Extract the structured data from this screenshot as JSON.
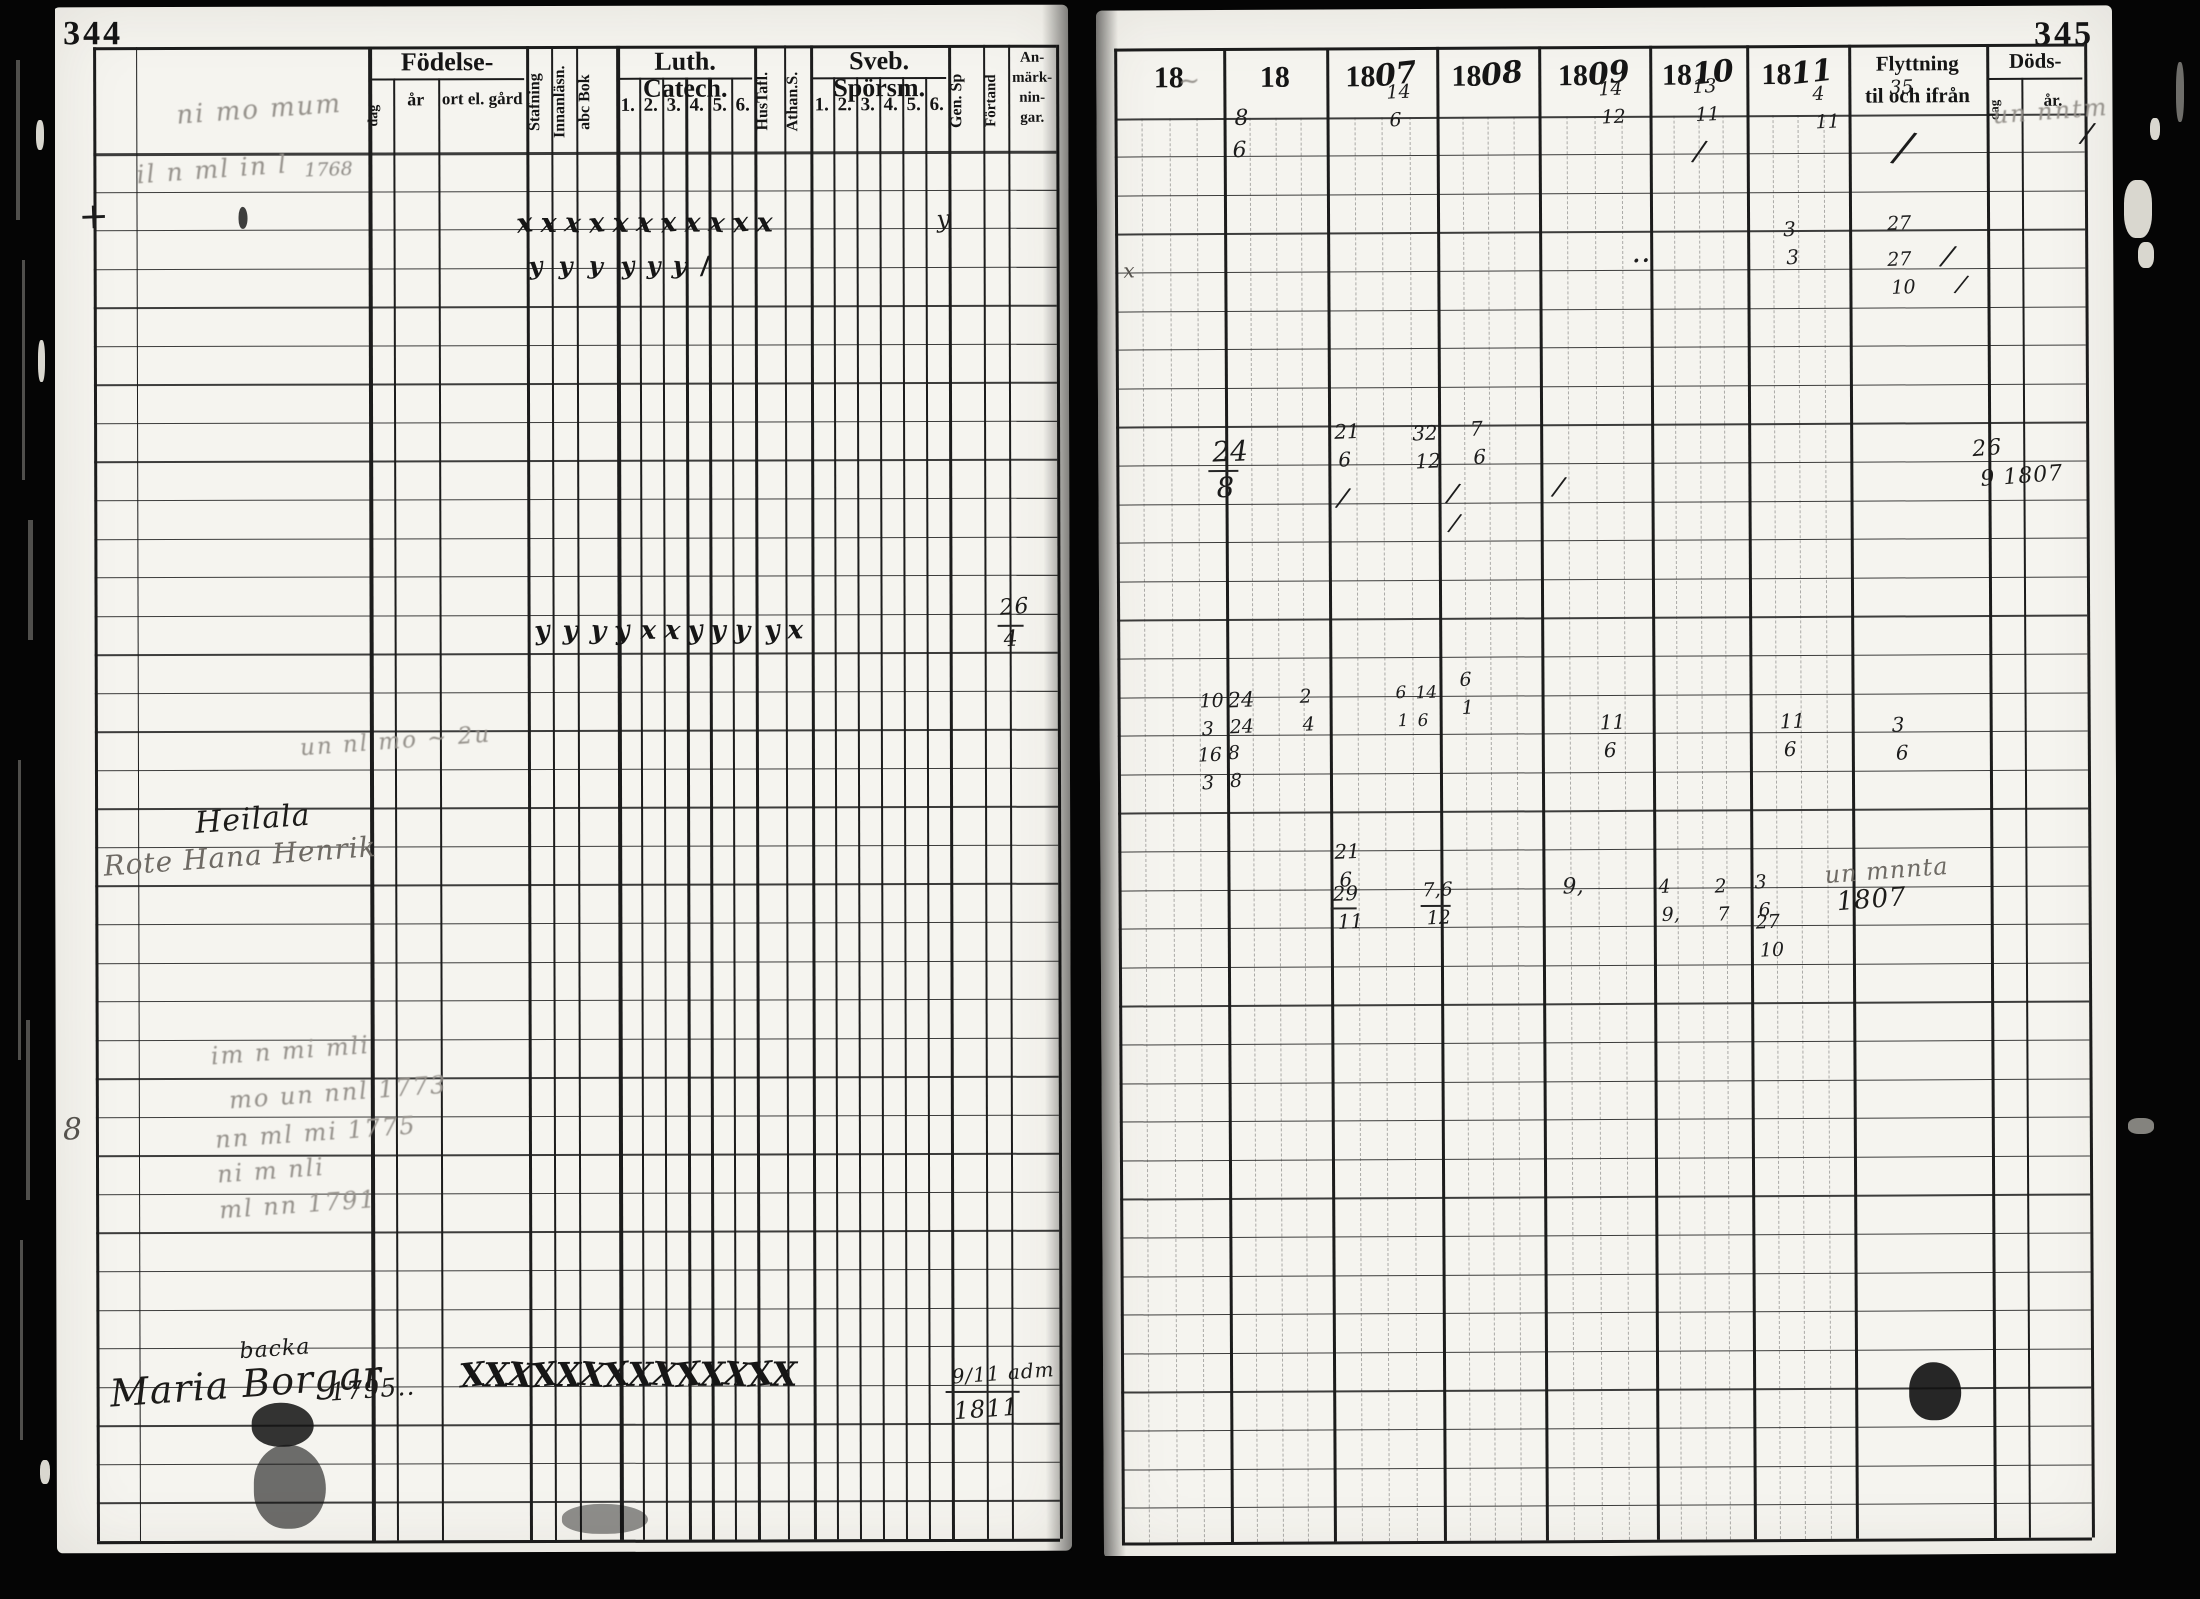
{
  "scan": {
    "left_page_number": "344",
    "right_page_number": "345"
  },
  "left_page": {
    "header": {
      "fodelse_group": "Födelse-",
      "fodelse_sub": [
        "dag",
        "år",
        "ort el. gård"
      ],
      "reading_cols": [
        "Stafning",
        "Innanläsn.",
        "abc Bok"
      ],
      "luth_group": "Luth. Catech.",
      "luth_sub": [
        "1.",
        "2.",
        "3.",
        "4.",
        "5.",
        "6."
      ],
      "mid_cols": [
        "HusTafl.",
        "Athan.S."
      ],
      "sveb_group": "Sveb. Spörsm.",
      "sveb_sub": [
        "1.",
        "2.",
        "3.",
        "4.",
        "5.",
        "6."
      ],
      "tail_cols": [
        "Gen. Sp",
        "Förtand"
      ],
      "anmarkningar_lines": [
        "An-",
        "märk-",
        "nin-",
        "gar."
      ]
    },
    "mark_rows": [
      {
        "y": 210,
        "x0": 518,
        "dx": 24,
        "n": 11,
        "g": "x",
        "f": 27
      },
      {
        "y": 254,
        "xs": [
          530,
          560,
          590,
          622,
          648,
          674,
          702
        ],
        "gs": [
          "y",
          "y",
          "y",
          "y",
          "y",
          "y",
          "/"
        ],
        "f": 24
      },
      {
        "y": 618,
        "xs": [
          535,
          563,
          591,
          615,
          641,
          665,
          688,
          711,
          735,
          765,
          788
        ],
        "gs": [
          "y",
          "y",
          "y",
          "y",
          "x",
          "x",
          "y",
          "y",
          "y",
          "y",
          "x"
        ],
        "f": 26
      },
      {
        "y": 1358,
        "x0": 458,
        "dx": 24,
        "n": 14,
        "g": "X",
        "f": 33
      }
    ],
    "ink": [
      {
        "x": 178,
        "y": 96,
        "t": "ni mo mum",
        "s": "fc",
        "f": 26
      },
      {
        "x": 138,
        "y": 156,
        "t": "il n ml in l",
        "s": "fc",
        "f": 25
      },
      {
        "x": 306,
        "y": 160,
        "t": "1768",
        "s": "f",
        "f": 19
      },
      {
        "x": 80,
        "y": 198,
        "t": "+",
        "f": 36
      },
      {
        "x": 938,
        "y": 208,
        "t": "y",
        "s": "c",
        "f": 24
      },
      {
        "x": 240,
        "y": 206,
        "w": 9,
        "h": 22,
        "s": "blot",
        "o": 0.8
      },
      {
        "x": 300,
        "y": 730,
        "t": "un nl mo ~ 2u",
        "s": "fc",
        "f": 23
      },
      {
        "x": 1000,
        "y": 598,
        "t": "26",
        "s": "c",
        "f": 22
      },
      {
        "x": 998,
        "y": 626,
        "w": 26,
        "s": "hl"
      },
      {
        "x": 1004,
        "y": 630,
        "t": "4",
        "s": "c",
        "f": 22
      },
      {
        "x": 195,
        "y": 804,
        "t": "Heilala",
        "s": "c",
        "f": 30
      },
      {
        "x": 103,
        "y": 842,
        "t": "Rote Hana Henrik",
        "s": "c2",
        "f": 28
      },
      {
        "x": 210,
        "y": 1038,
        "t": "im n mi mli",
        "s": "fc",
        "f": 24
      },
      {
        "x": 228,
        "y": 1080,
        "t": "mo un nnl 1773",
        "s": "fc",
        "f": 24
      },
      {
        "x": 214,
        "y": 1120,
        "t": "nn ml mi 1775",
        "s": "fc",
        "f": 24
      },
      {
        "x": 216,
        "y": 1158,
        "t": "ni m nli",
        "s": "fc",
        "f": 24
      },
      {
        "x": 218,
        "y": 1192,
        "t": "ml nn 1791",
        "s": "fc",
        "f": 24
      },
      {
        "x": 62,
        "y": 1114,
        "t": "8",
        "s": "il",
        "f": 30
      },
      {
        "x": 108,
        "y": 1364,
        "t": "Maria Borgar",
        "s": "c",
        "f": 38
      },
      {
        "x": 238,
        "y": 1338,
        "t": "backa",
        "s": "c",
        "f": 22
      },
      {
        "x": 328,
        "y": 1376,
        "t": "1795..",
        "s": "c",
        "f": 25
      },
      {
        "x": 950,
        "y": 1364,
        "t": "9/11 adm",
        "s": "c",
        "f": 20
      },
      {
        "x": 944,
        "y": 1392,
        "w": 74,
        "s": "hl"
      },
      {
        "x": 952,
        "y": 1398,
        "t": "1811",
        "s": "c",
        "f": 24
      },
      {
        "x": 250,
        "y": 1402,
        "w": 62,
        "h": 44,
        "s": "blot",
        "o": 0.85
      },
      {
        "x": 252,
        "y": 1444,
        "w": 72,
        "h": 84,
        "s": "blot",
        "o": 0.6
      },
      {
        "x": 560,
        "y": 1504,
        "w": 86,
        "h": 30,
        "s": "blot",
        "o": 0.45
      }
    ]
  },
  "right_page": {
    "header": {
      "years": [
        {
          "p": "18",
          "s": ""
        },
        {
          "p": "18",
          "s": ""
        },
        {
          "p": "18",
          "s": "07"
        },
        {
          "p": "18",
          "s": "08"
        },
        {
          "p": "18",
          "s": "09"
        },
        {
          "p": "18",
          "s": "10"
        },
        {
          "p": "18",
          "s": "11"
        }
      ],
      "flyttning_lines": [
        "Flyttning",
        "til och ifrån"
      ],
      "dods": "Döds-",
      "dods_sub": [
        "dag",
        "år."
      ]
    },
    "ink": [
      {
        "x": 1182,
        "y": 66,
        "t": "~",
        "s": "fc",
        "f": 26
      },
      {
        "x": 1238,
        "y": 106,
        "t": "8",
        "f": 22
      },
      {
        "x": 1236,
        "y": 138,
        "t": "6",
        "f": 22
      },
      {
        "x": 1390,
        "y": 82,
        "t": "14",
        "f": 19
      },
      {
        "x": 1393,
        "y": 110,
        "t": "6",
        "f": 19
      },
      {
        "x": 1602,
        "y": 80,
        "t": "14",
        "f": 19
      },
      {
        "x": 1605,
        "y": 108,
        "t": "12",
        "f": 19
      },
      {
        "x": 1696,
        "y": 78,
        "t": "13",
        "f": 19
      },
      {
        "x": 1699,
        "y": 106,
        "t": "11",
        "f": 19
      },
      {
        "x": 1816,
        "y": 86,
        "t": "4",
        "f": 19
      },
      {
        "x": 1819,
        "y": 114,
        "t": "11",
        "f": 19
      },
      {
        "x": 1893,
        "y": 80,
        "t": "35",
        "f": 19
      },
      {
        "x": 1900,
        "y": 128,
        "t": "/",
        "f": 42,
        "r": 12
      },
      {
        "x": 1996,
        "y": 100,
        "t": "un nntm mi",
        "s": "fc",
        "f": 24
      },
      {
        "x": 2086,
        "y": 122,
        "t": "/",
        "f": 28,
        "r": 10
      },
      {
        "x": 1126,
        "y": 258,
        "t": "x",
        "s": "il",
        "f": 20
      },
      {
        "x": 1698,
        "y": 138,
        "t": "/",
        "f": 28,
        "r": 8
      },
      {
        "x": 1786,
        "y": 220,
        "t": "3",
        "f": 20
      },
      {
        "x": 1789,
        "y": 248,
        "t": "3",
        "f": 20
      },
      {
        "x": 1890,
        "y": 216,
        "t": "27",
        "f": 19
      },
      {
        "x": 1890,
        "y": 252,
        "t": "27",
        "f": 19
      },
      {
        "x": 1894,
        "y": 280,
        "t": "10",
        "f": 19
      },
      {
        "x": 1946,
        "y": 244,
        "t": "/",
        "f": 28,
        "r": 12
      },
      {
        "x": 1960,
        "y": 274,
        "t": "/",
        "f": 24,
        "r": 12
      },
      {
        "x": 1634,
        "y": 238,
        "t": "..",
        "f": 30
      },
      {
        "x": 1214,
        "y": 436,
        "t": "24",
        "f": 28
      },
      {
        "x": 1210,
        "y": 468,
        "w": 30,
        "s": "hl"
      },
      {
        "x": 1218,
        "y": 472,
        "t": "8",
        "f": 28
      },
      {
        "x": 1336,
        "y": 420,
        "t": "21",
        "f": 20
      },
      {
        "x": 1340,
        "y": 448,
        "t": "6",
        "f": 20
      },
      {
        "x": 1414,
        "y": 422,
        "t": "32",
        "f": 20
      },
      {
        "x": 1417,
        "y": 450,
        "t": "12",
        "f": 20
      },
      {
        "x": 1472,
        "y": 418,
        "t": "7",
        "f": 20
      },
      {
        "x": 1475,
        "y": 446,
        "t": "6",
        "f": 20
      },
      {
        "x": 1340,
        "y": 484,
        "t": "/",
        "f": 26,
        "r": 10
      },
      {
        "x": 1450,
        "y": 480,
        "t": "/",
        "f": 26,
        "r": 10
      },
      {
        "x": 1556,
        "y": 474,
        "t": "/",
        "f": 26,
        "r": 10
      },
      {
        "x": 1452,
        "y": 510,
        "t": "/",
        "f": 24,
        "r": 10
      },
      {
        "x": 1974,
        "y": 440,
        "t": "26",
        "s": "c",
        "f": 22
      },
      {
        "x": 1982,
        "y": 468,
        "t": "9 1807",
        "s": "c",
        "f": 22
      },
      {
        "x": 1200,
        "y": 690,
        "t": "10",
        "f": 19
      },
      {
        "x": 1228,
        "y": 688,
        "t": "24",
        "f": 21
      },
      {
        "x": 1202,
        "y": 718,
        "t": "3",
        "f": 19
      },
      {
        "x": 1230,
        "y": 716,
        "t": "24",
        "f": 19
      },
      {
        "x": 1198,
        "y": 744,
        "t": "16",
        "f": 19
      },
      {
        "x": 1228,
        "y": 742,
        "t": "8",
        "f": 19
      },
      {
        "x": 1202,
        "y": 772,
        "t": "3",
        "f": 19
      },
      {
        "x": 1230,
        "y": 770,
        "t": "8",
        "f": 19
      },
      {
        "x": 1300,
        "y": 686,
        "t": "2",
        "f": 19
      },
      {
        "x": 1303,
        "y": 714,
        "t": "4",
        "f": 19
      },
      {
        "x": 1396,
        "y": 684,
        "t": "6",
        "f": 17
      },
      {
        "x": 1416,
        "y": 684,
        "t": "14",
        "f": 17
      },
      {
        "x": 1398,
        "y": 712,
        "t": "1",
        "f": 17
      },
      {
        "x": 1418,
        "y": 712,
        "t": "6",
        "f": 17
      },
      {
        "x": 1460,
        "y": 670,
        "t": "6",
        "f": 19
      },
      {
        "x": 1462,
        "y": 698,
        "t": "1",
        "f": 19
      },
      {
        "x": 1600,
        "y": 712,
        "t": "11",
        "f": 20
      },
      {
        "x": 1604,
        "y": 740,
        "t": "6",
        "f": 20
      },
      {
        "x": 1780,
        "y": 712,
        "t": "11",
        "f": 20
      },
      {
        "x": 1784,
        "y": 740,
        "t": "6",
        "f": 20
      },
      {
        "x": 1892,
        "y": 716,
        "t": "3",
        "f": 20
      },
      {
        "x": 1896,
        "y": 744,
        "t": "6",
        "f": 20
      },
      {
        "x": 1334,
        "y": 840,
        "t": "21",
        "f": 20
      },
      {
        "x": 1339,
        "y": 868,
        "t": "6",
        "f": 20
      },
      {
        "x": 1332,
        "y": 882,
        "t": "29",
        "f": 20
      },
      {
        "x": 1330,
        "y": 906,
        "w": 26,
        "s": "hl"
      },
      {
        "x": 1337,
        "y": 910,
        "t": "11",
        "f": 20
      },
      {
        "x": 1422,
        "y": 880,
        "t": "7,6",
        "f": 19
      },
      {
        "x": 1420,
        "y": 904,
        "w": 30,
        "s": "hl"
      },
      {
        "x": 1426,
        "y": 908,
        "t": "12",
        "f": 19
      },
      {
        "x": 1562,
        "y": 876,
        "t": "9,",
        "f": 22
      },
      {
        "x": 1658,
        "y": 878,
        "t": "4",
        "f": 19
      },
      {
        "x": 1661,
        "y": 906,
        "t": "9,",
        "f": 19
      },
      {
        "x": 1714,
        "y": 878,
        "t": "2",
        "f": 19
      },
      {
        "x": 1717,
        "y": 906,
        "t": "7",
        "f": 19
      },
      {
        "x": 1754,
        "y": 874,
        "t": "3",
        "f": 19
      },
      {
        "x": 1758,
        "y": 902,
        "t": "6",
        "f": 19
      },
      {
        "x": 1755,
        "y": 914,
        "t": "27",
        "f": 19
      },
      {
        "x": 1759,
        "y": 942,
        "t": "10",
        "f": 19
      },
      {
        "x": 1824,
        "y": 860,
        "t": "un mnnta",
        "s": "c2",
        "f": 24
      },
      {
        "x": 1836,
        "y": 888,
        "t": "1807",
        "s": "c",
        "f": 26
      },
      {
        "x": 1906,
        "y": 1364,
        "w": 52,
        "h": 58,
        "s": "blot",
        "o": 0.9
      }
    ]
  }
}
